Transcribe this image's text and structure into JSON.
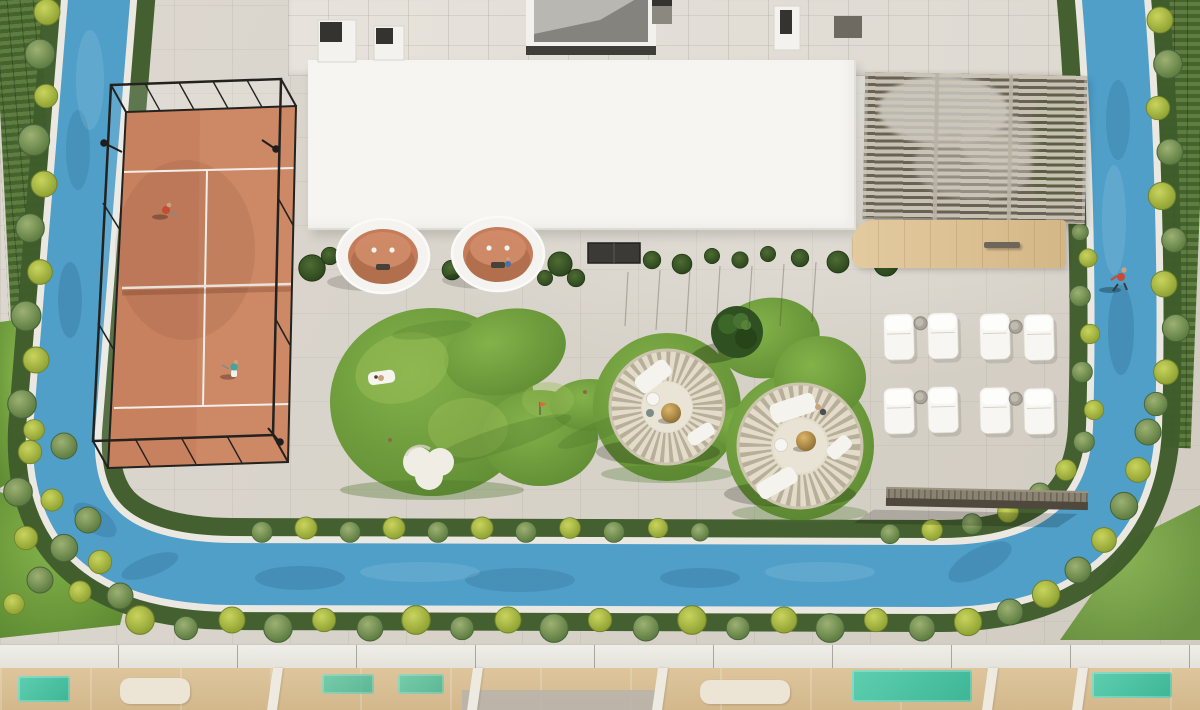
{
  "scene": {
    "type": "architectural-aerial-render",
    "description": "Aerial 3D rendering of a rooftop amenity deck: padel court with black cage, blue jogging track loop lined with hedges, organic putting green with sand bunker, two round rattan nest cabanas on circular lawns, cylindrical lounge pods, slatted pergola lounge with wood deck, and a sun deck with white loungers above lower-level terraces",
    "counts": {
      "padel_players": 2,
      "joggers": 1,
      "sunbathers": 1,
      "lounge_chairs": 8,
      "side_tables": 4,
      "nest_cabanas": 2,
      "cabana_pods": 2,
      "pergolas": 1,
      "padel_courts": 1,
      "sand_bunkers": 1,
      "ornamental_trees": 1,
      "benches": 2
    }
  },
  "palette": {
    "paving": "#d9d4cb",
    "track": "#4f9fc9",
    "track-deep": "#3f8db8",
    "curb": "#eae8e1",
    "hedge": "#3f5c2b",
    "bush-yellow": "#a9b441",
    "bush-green": "#6e8c4a",
    "shrub": "#3a5627",
    "lawn": "#6f9e3c",
    "lawn-light": "#9cbd57",
    "lawn-dark": "#4c762a",
    "clay": "#c8815f",
    "clay-light": "#d3916f",
    "cage": "#24221f",
    "court-line": "#f3efe8",
    "roof": "#f6f5f1",
    "upper-roof": "#e4e0d9",
    "slat": "#c9c2b1",
    "wood": "#dcc298",
    "nest": "#b4aa94",
    "nest-base": "#e3dccb",
    "cushion": "#f5f3ed",
    "gold": "#b3904b",
    "teal": "#45c3a5",
    "lower-wood": "#dcc29b",
    "parapet": "#ecebe4",
    "door": "#3b3a37",
    "red-shirt": "#c64b32",
    "teal-shirt": "#3aa7a0",
    "skin": "#caa37e",
    "sand": "#f0ede4"
  }
}
